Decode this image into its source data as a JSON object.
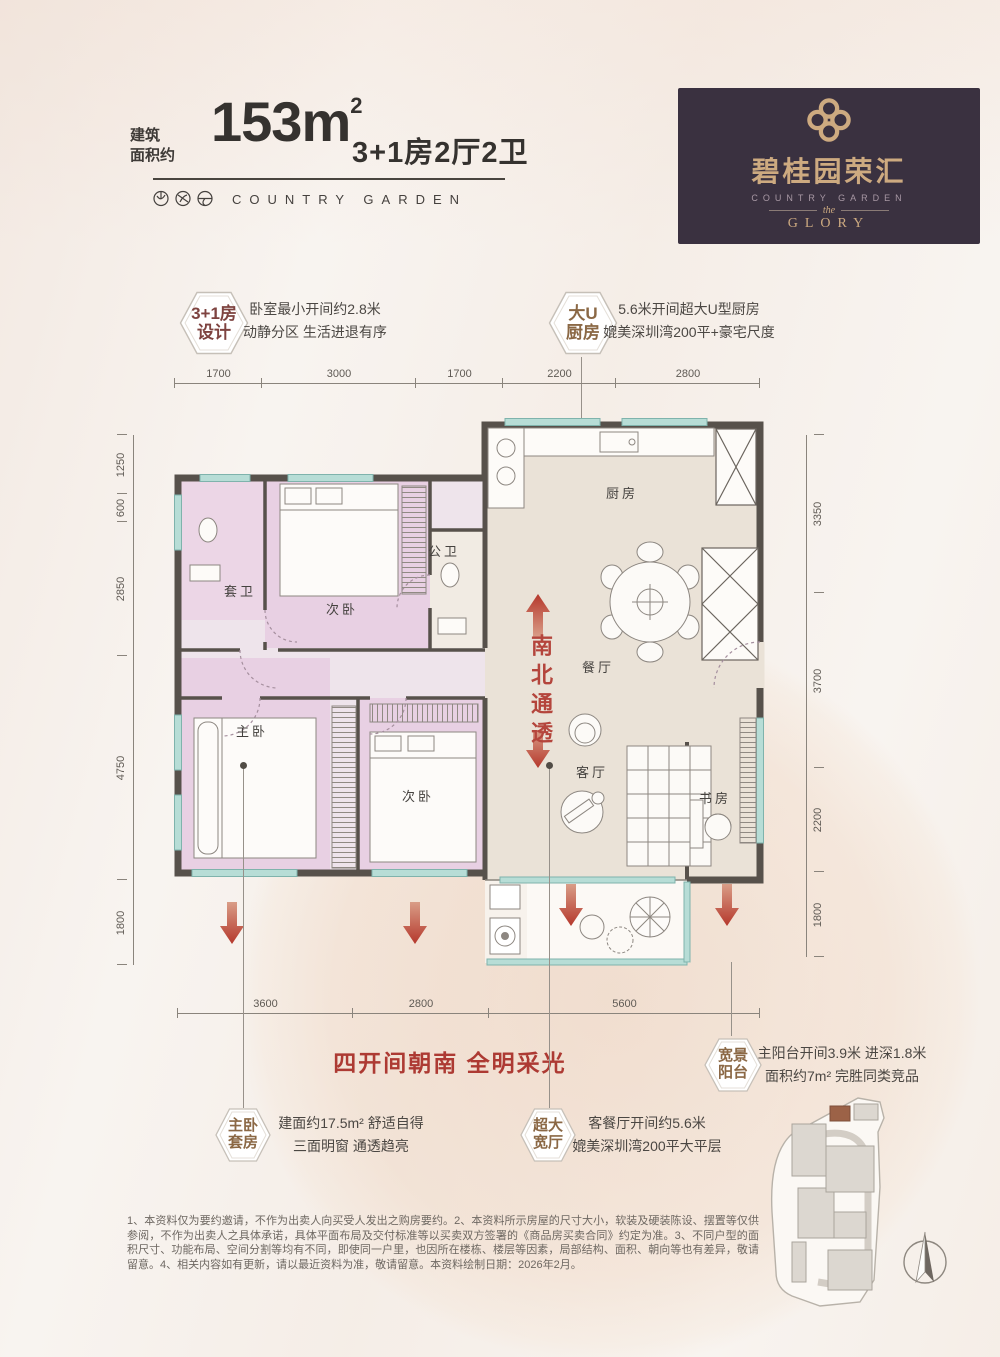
{
  "header": {
    "area_label_line1": "建筑",
    "area_label_line2": "面积约",
    "area_number": "153",
    "area_unit": "m",
    "area_unit_sup": "2",
    "layout": "3+1房2厅2卫",
    "brand": "COUNTRY GARDEN"
  },
  "logo_box": {
    "brand_cn": "碧桂园荣汇",
    "brand_en": "COUNTRY GARDEN",
    "the_label": "the",
    "glory_label": "GLORY"
  },
  "callouts": {
    "design": {
      "badge1": "3+1房",
      "badge2": "设计",
      "desc1": "卧室最小开间约2.8米",
      "desc2": "动静分区 生活进退有序"
    },
    "kitchen": {
      "badge1": "大U",
      "badge2": "厨房",
      "desc1": "5.6米开间超大U型厨房",
      "desc2": "媲美深圳湾200平+豪宅尺度"
    },
    "balcony": {
      "badge1": "宽景",
      "badge2": "阳台",
      "desc1": "主阳台开间3.9米 进深1.8米",
      "desc2": "面积约7m² 完胜同类竞品"
    },
    "master": {
      "badge1": "主卧",
      "badge2": "套房",
      "desc1": "建面约17.5m² 舒适自得",
      "desc2": "三面明窗 通透趋亮"
    },
    "living": {
      "badge1": "超大",
      "badge2": "宽厅",
      "desc1": "客餐厅开间约5.6米",
      "desc2": "媲美深圳湾200平大平层"
    }
  },
  "floorplan": {
    "rooms": {
      "kitchen": "厨房",
      "dining": "餐厅",
      "living": "客厅",
      "study": "书房",
      "master": "主卧",
      "bedroom2": "次卧",
      "bedroom3": "次卧",
      "ensuite_bath": "套卫",
      "public_bath": "公卫"
    },
    "ns_through": "南北通透",
    "dims_top": [
      "1700",
      "3000",
      "1700",
      "2200",
      "2800"
    ],
    "dims_left": [
      "1250",
      "600",
      "2850",
      "4750",
      "1800"
    ],
    "dims_right": [
      "3350",
      "3700",
      "2200",
      "1800"
    ],
    "dims_bottom": [
      "3600",
      "2800",
      "5600"
    ]
  },
  "slogan": "四开间朝南 全明采光",
  "disclaimer": "1、本资料仅为要约邀请，不作为出卖人向买受人发出之购房要约。2、本资料所示房屋的尺寸大小，软装及硬装陈设、摆置等仅供参阅，不作为出卖人之具体承诺，具体平面布局及交付标准等以买卖双方签署的《商品房买卖合同》约定为准。3、不同户型的面积尺寸、功能布局、空间分割等均有不同，即使同一户里，也因所在楼栋、楼层等因素，局部结构、面积、朝向等也有差异，敬请留意。4、相关内容如有更新，请以最近资料为准，敬请留意。本资料绘制日期：2026年2月。",
  "colors": {
    "accent_red": "#b23a31",
    "badge_design": "#7e4340",
    "badge_brown": "#8b6845",
    "logo_bg": "#3a3140",
    "logo_gold": "#cdaa80",
    "wall": "#57514b",
    "window_teal": "#8fbdb6",
    "bedroom_pink": "#e8d0e3",
    "floor_beige": "#eae2d7"
  }
}
